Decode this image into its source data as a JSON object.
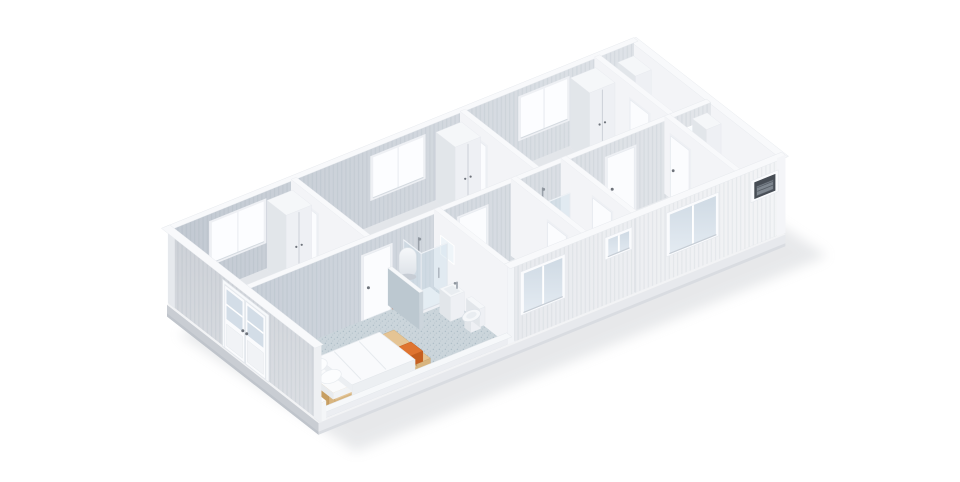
{
  "view": {
    "type": "isometric-3d-floorplan-render",
    "subject": "modular container building, roofless cutaway view",
    "background": "#ffffff"
  },
  "colors": {
    "background": "#ffffff",
    "shadow": "#a3a8b0",
    "base_side": "#e7e9ed",
    "base_west": "#c9cdd3",
    "base_top": "#f2f3f5",
    "base_edge": "#d9dce1",
    "floor_gray": "#e3e6ea",
    "floor_white": "#ebedf0",
    "floor_blue": "#cbd5db",
    "floor_speckle": "#8fa3b0",
    "wall_top": "#f8f9fb",
    "int_face": "#f3f4f7",
    "int_end": "#e7eaee",
    "back_wall_dark": "#c2c9d2",
    "back_wall_light": "#dfe3e8",
    "central_dark": "#c8cfd8",
    "central_light": "#e3e6ea",
    "front_dark": "#e8eaee",
    "front_light": "#f3f4f6",
    "west_dark": "#cdd1d7",
    "west_light": "#dcdfe4",
    "glass_ext_top": "#cfdae4",
    "glass_ext_bot": "#e4ebf2",
    "glass_int": "#fcfdff",
    "frame": "#fafbfd",
    "mullion": "#ffffff",
    "sill": "#c6cdd5",
    "door": "#fbfcfe",
    "door_frame": "#eef0f4",
    "handle": "#6e737b",
    "wood_top": "#e5c494",
    "wood_side": "#d8b57f",
    "wood_west": "#c79f63",
    "wood_leg": "#b9905a",
    "duvet": "#f9fafc",
    "duvet_shade": "#eceff2",
    "bedding_edge": "#e4e8ec",
    "towel": "#df7430",
    "towel_dark": "#c55f20",
    "fixture": "#f5f7f9",
    "fixture_side": "#eef0f4",
    "fixture_west": "#e2e6ea",
    "glass_shower": "rgba(205,221,233,0.45)",
    "shower_frame": "#d9dfe6",
    "metal": "#9aa1aa",
    "boiler_cap": "#c7cdd5",
    "mirror": "#eff5f9",
    "mirror_bright": "#fafdff",
    "ac_dark": "#474d55",
    "ac_unit": "#7f8790",
    "accent": "#cf5c28",
    "halfwall": "#ccd5dc",
    "halfwall_west": "#bcc8d0",
    "seam": "#dcdfe4"
  },
  "rooms": [
    "back-room-1",
    "back-room-2",
    "back-room-3",
    "back-bathroom",
    "bedroom-with-ensuite",
    "unit-2-room",
    "unit-2-bathroom",
    "unit-3-room",
    "unit-3-bathroom"
  ],
  "fixtures": [
    "bed",
    "bed-bench",
    "orange-towel",
    "water-heater",
    "shower-cabin",
    "toilet",
    "washbasin",
    "mirror",
    "wardrobe",
    "washer-block",
    "ac-vent-unit",
    "french-door"
  ],
  "scene": [
    {
      "k": "shadow",
      "n": "ground-shadow"
    },
    {
      "k": "base",
      "n": "chassis-base"
    },
    {
      "k": "floor",
      "n": "floor-back-room-1",
      "u": [
        0,
        3.1
      ],
      "v": [
        0,
        3
      ],
      "f": "gray"
    },
    {
      "k": "floor",
      "n": "floor-back-room-2",
      "u": [
        3.1,
        7.5
      ],
      "v": [
        0,
        3
      ],
      "f": "gray"
    },
    {
      "k": "floor",
      "n": "floor-back-room-3",
      "u": [
        7.5,
        11.0
      ],
      "v": [
        0,
        3
      ],
      "f": "gray"
    },
    {
      "k": "floor",
      "n": "floor-back-bathroom",
      "u": [
        11.0,
        12
      ],
      "v": [
        0,
        3
      ],
      "f": "blue"
    },
    {
      "k": "floor",
      "n": "floor-bedroom",
      "u": [
        0,
        4.9
      ],
      "v": [
        3,
        6
      ],
      "f": "blue"
    },
    {
      "k": "floor",
      "n": "floor-unit-2-room",
      "u": [
        4.9,
        6.9
      ],
      "v": [
        3,
        6
      ],
      "f": "white"
    },
    {
      "k": "floor",
      "n": "floor-unit-2-bath",
      "u": [
        6.9,
        8.2
      ],
      "v": [
        3,
        6
      ],
      "f": "white"
    },
    {
      "k": "floor",
      "n": "floor-unit-3-room",
      "u": [
        8.2,
        10.9
      ],
      "v": [
        3,
        6
      ],
      "f": "white"
    },
    {
      "k": "floor",
      "n": "floor-unit-3-bath",
      "u": [
        10.9,
        12
      ],
      "v": [
        3,
        6
      ],
      "f": "blue"
    },
    {
      "k": "ewall",
      "n": "east-end-wall"
    },
    {
      "k": "bwall",
      "n": "back-wall"
    },
    {
      "k": "bwin",
      "n": "back-window-1",
      "u": [
        1.0,
        2.35
      ]
    },
    {
      "k": "bwin",
      "n": "back-window-2",
      "u": [
        5.2,
        6.5
      ]
    },
    {
      "k": "bwin",
      "n": "back-window-3",
      "u": [
        9.05,
        10.25
      ]
    },
    {
      "k": "mirror",
      "n": "mirror-back-bath",
      "plane": "B",
      "u": [
        11.08,
        11.5
      ],
      "z": [
        1.2,
        1.9
      ]
    },
    {
      "k": "block",
      "n": "shower-unit-back-bath",
      "u": [
        11.56,
        11.97
      ],
      "v": [
        0.08,
        0.8
      ],
      "z": [
        0,
        2.1
      ],
      "plain": true
    },
    {
      "k": "sink",
      "n": "sink-back-bath",
      "u": [
        11.06,
        11.5
      ],
      "v": [
        0.1,
        0.52
      ],
      "tap": "N"
    },
    {
      "k": "xwall",
      "n": "partition-back-bath",
      "u": 11.0,
      "v": [
        0,
        3
      ]
    },
    {
      "k": "doorw",
      "n": "door-back-bath",
      "u": 11.0,
      "v": [
        1.5,
        2.25
      ]
    },
    {
      "k": "block",
      "n": "wardrobe-3",
      "u": [
        10.3,
        10.96
      ],
      "v": [
        0.12,
        0.9
      ],
      "z": [
        0,
        2.25
      ]
    },
    {
      "k": "xwall",
      "n": "partition-back-2",
      "u": 7.5,
      "v": [
        0,
        3
      ]
    },
    {
      "k": "doorw",
      "n": "door-back-room-3",
      "u": 7.5,
      "v": [
        0.35,
        1.1
      ]
    },
    {
      "k": "block",
      "n": "wardrobe-2",
      "u": [
        6.8,
        7.46
      ],
      "v": [
        0.12,
        0.9
      ],
      "z": [
        0,
        2.25
      ]
    },
    {
      "k": "xwall",
      "n": "partition-back-1",
      "u": 3.1,
      "v": [
        0,
        3
      ]
    },
    {
      "k": "doorw",
      "n": "door-back-room-2",
      "u": 3.1,
      "v": [
        0.35,
        1.1
      ]
    },
    {
      "k": "block",
      "n": "wardrobe-1",
      "u": [
        2.4,
        3.06
      ],
      "v": [
        0.12,
        0.9
      ],
      "z": [
        0,
        2.25
      ]
    },
    {
      "k": "cwall",
      "n": "central-corridor-wall"
    },
    {
      "k": "doorc",
      "n": "door-bedroom",
      "u": [
        2.95,
        3.65
      ]
    },
    {
      "k": "doorc",
      "n": "door-unit-2",
      "u": [
        5.45,
        6.15
      ]
    },
    {
      "k": "doorc",
      "n": "door-unit-3",
      "u": [
        9.3,
        10.0
      ]
    },
    {
      "k": "mirror",
      "n": "mirror-unit-3-bath",
      "plane": "C",
      "u": [
        11.05,
        11.6
      ],
      "z": [
        1.15,
        2.0
      ]
    },
    {
      "k": "dot",
      "n": "door-stop-1",
      "p": [
        3.72,
        3.2,
        0.05
      ]
    },
    {
      "k": "dot",
      "n": "door-stop-2",
      "p": [
        7.05,
        3.2,
        0.05
      ]
    },
    {
      "k": "block",
      "n": "shower-unit-3-bath",
      "u": [
        11.6,
        11.98
      ],
      "v": [
        3.05,
        3.62
      ],
      "z": [
        0,
        2.1
      ],
      "plain": true
    },
    {
      "k": "sink",
      "n": "sink-unit-3-bath",
      "u": [
        11.15,
        11.55
      ],
      "v": [
        3.1,
        3.52
      ],
      "tap": "N"
    },
    {
      "k": "toilet",
      "n": "toilet-unit-3-bath",
      "u": [
        11.18,
        11.6
      ],
      "v": [
        4.88,
        5.5
      ]
    },
    {
      "k": "xwall",
      "n": "partition-unit-3-bath",
      "u": 10.9,
      "v": [
        3,
        6
      ]
    },
    {
      "k": "doorw",
      "n": "door-unit-3-bath",
      "u": 10.9,
      "v": [
        3.3,
        4.05
      ]
    },
    {
      "k": "xwall",
      "n": "partition-unit-2-3",
      "u": 8.2,
      "v": [
        3,
        6
      ]
    },
    {
      "k": "doorw",
      "n": "door-unit-3-side",
      "u": 8.2,
      "v": [
        4.35,
        5.1
      ]
    },
    {
      "k": "shower",
      "n": "shower-unit-2-bath",
      "u": [
        7.32,
        7.96
      ],
      "v": [
        3.06,
        3.74
      ]
    },
    {
      "k": "sink",
      "n": "sink-unit-2-bath",
      "u": [
        6.98,
        7.34
      ],
      "v": [
        3.08,
        3.5
      ],
      "tap": "N"
    },
    {
      "k": "mirror",
      "n": "mirror-unit-2-bath",
      "plane": "C",
      "u": [
        6.96,
        7.38
      ],
      "z": [
        1.25,
        1.9
      ]
    },
    {
      "k": "block",
      "n": "washer-unit-2-bath",
      "u": [
        7.05,
        7.8
      ],
      "v": [
        5.28,
        5.93
      ],
      "z": [
        0,
        0.85
      ],
      "plain": true
    },
    {
      "k": "xwall",
      "n": "partition-unit-2-bath",
      "u": 6.9,
      "v": [
        3,
        6
      ]
    },
    {
      "k": "doorw",
      "n": "door-unit-2-bath",
      "u": 6.9,
      "v": [
        4.55,
        5.3
      ]
    },
    {
      "k": "xwall",
      "n": "partition-unit-1-2",
      "u": 4.9,
      "v": [
        3,
        6
      ]
    },
    {
      "k": "mirror",
      "n": "mirror-bedroom-bath",
      "plane": "W",
      "at": 4.88,
      "v": [
        3.3,
        3.85
      ],
      "z": [
        1.25,
        1.85
      ]
    },
    {
      "k": "shower",
      "n": "shower-bedroom-bath",
      "u": [
        4.08,
        4.76
      ],
      "v": [
        3.05,
        3.76
      ]
    },
    {
      "k": "boiler",
      "n": "water-heater",
      "p": [
        3.93,
        3.45
      ]
    },
    {
      "k": "sink",
      "n": "sink-bedroom-bath",
      "u": [
        4.42,
        4.78
      ],
      "v": [
        3.98,
        4.42
      ],
      "tap": "E"
    },
    {
      "k": "toilet",
      "n": "toilet-bedroom-bath",
      "u": [
        4.4,
        4.8
      ],
      "v": [
        4.64,
        5.28
      ]
    },
    {
      "k": "halfwall",
      "n": "bath-half-wall",
      "u": 3.7,
      "v": [
        3,
        4.28
      ]
    },
    {
      "k": "bench",
      "n": "bed-bench",
      "u": [
        2.6,
        2.95
      ],
      "v": [
        4.42,
        5.9
      ]
    },
    {
      "k": "towel",
      "n": "orange-towel"
    },
    {
      "k": "bed",
      "n": "bed"
    },
    {
      "k": "fwall",
      "n": "front-wall"
    },
    {
      "k": "fwin",
      "n": "front-window-unit-2",
      "u": [
        5.3,
        6.3
      ],
      "z": [
        0.85,
        2.1
      ],
      "style": "glass"
    },
    {
      "k": "fwin",
      "n": "front-window-unit-2-bath",
      "u": [
        7.5,
        8.04
      ],
      "z": [
        1.55,
        2.1
      ],
      "style": "glass"
    },
    {
      "k": "fwin",
      "n": "front-window-unit-3",
      "u": [
        9.1,
        10.3
      ],
      "z": [
        0.85,
        2.1
      ],
      "style": "glass"
    },
    {
      "k": "fwin",
      "n": "front-window-ac-vent",
      "u": [
        11.3,
        11.85
      ],
      "z": [
        1.5,
        2.04
      ],
      "style": "ac"
    },
    {
      "k": "wwall",
      "n": "west-end-wall"
    },
    {
      "k": "frenchdoor",
      "n": "french-door",
      "v": [
        2.2,
        3.9
      ]
    }
  ]
}
